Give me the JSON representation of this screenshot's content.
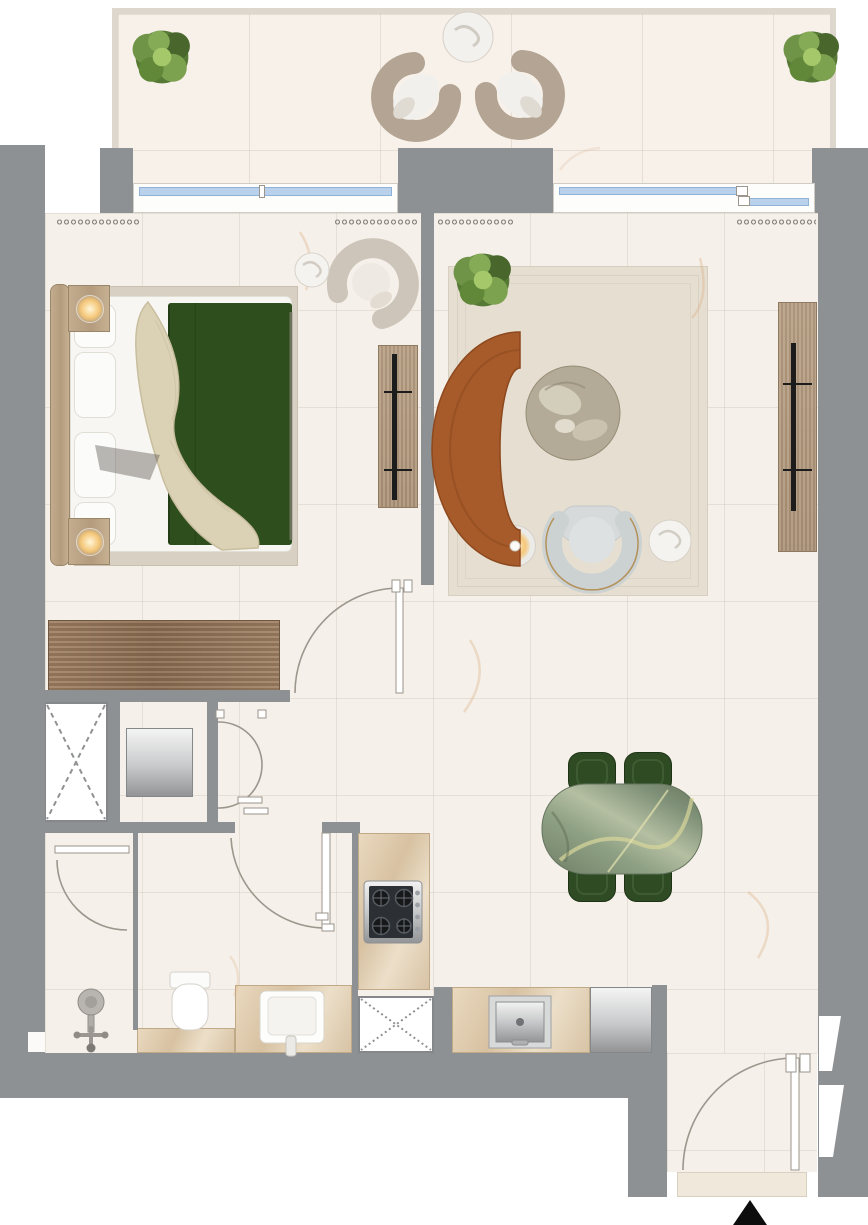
{
  "meta": {
    "type": "architectural-floor-plan",
    "view": "top-down-render",
    "text_on_image": "none",
    "marker": "north-arrow-black-triangle"
  },
  "palette": {
    "exterior_background": "#ffffff",
    "wall_gray": "#8e9193",
    "floor_cream": "#f5f0e9",
    "balcony_cream": "#f7f1ea",
    "window_glass_blue": "#b9d1ea",
    "sofa_terracotta": "#a75b2b",
    "bed_duvet_green": "#2f4e1d",
    "dining_green": "#2e4b24",
    "dining_marble_green": "#8fa184",
    "wood_light": "#b49b7d",
    "wardrobe_wood": "#8c6d51",
    "counter_marble_beige": "#dcc7a9",
    "rug_beige": "#e5decf",
    "appliance_steel": "#c9cacb",
    "lamp_glow": "#f5c87a"
  },
  "rooms": {
    "balcony": {
      "items": [
        "planter-bush-left",
        "planter-bush-right",
        "lounge-chair-left",
        "lounge-chair-right",
        "round-side-table"
      ]
    },
    "bedroom": {
      "items": [
        "double-bed",
        "pillows",
        "green-duvet",
        "cream-throw",
        "headboard",
        "nightstand-top",
        "nightstand-bottom",
        "table-lamp-top",
        "table-lamp-bottom",
        "bedroom-rug",
        "media-console",
        "tv",
        "curved-armchair",
        "round-side-table",
        "wardrobe",
        "bedroom-door"
      ]
    },
    "living_room": {
      "items": [
        "curved-terracotta-sofa",
        "round-marble-coffee-table",
        "floor-lamp",
        "curved-armchair",
        "round-side-table",
        "media-console",
        "tv",
        "living-rug",
        "potted-plant"
      ]
    },
    "dining_area": {
      "items": [
        "green-marble-dining-table",
        "dining-chair x4"
      ]
    },
    "kitchen": {
      "items": [
        "gas-hob-4-burner",
        "counter-with-sink",
        "refrigerator",
        "service-shaft"
      ]
    },
    "bathroom": {
      "items": [
        "shower-head",
        "toilet",
        "vanity-counter",
        "sink",
        "bath-door",
        "shower-door"
      ]
    },
    "utility": {
      "items": [
        "service-shaft",
        "washing-machine",
        "double-swing-doors"
      ]
    },
    "entry": {
      "items": [
        "entry-door",
        "door-threshold",
        "north-arrow"
      ]
    }
  },
  "openings": {
    "bedroom_window_panes": 2,
    "living_sliding_panels": 2,
    "door_swings": 6,
    "curtain_symbols": 4,
    "wall_vent_notches": 2
  }
}
